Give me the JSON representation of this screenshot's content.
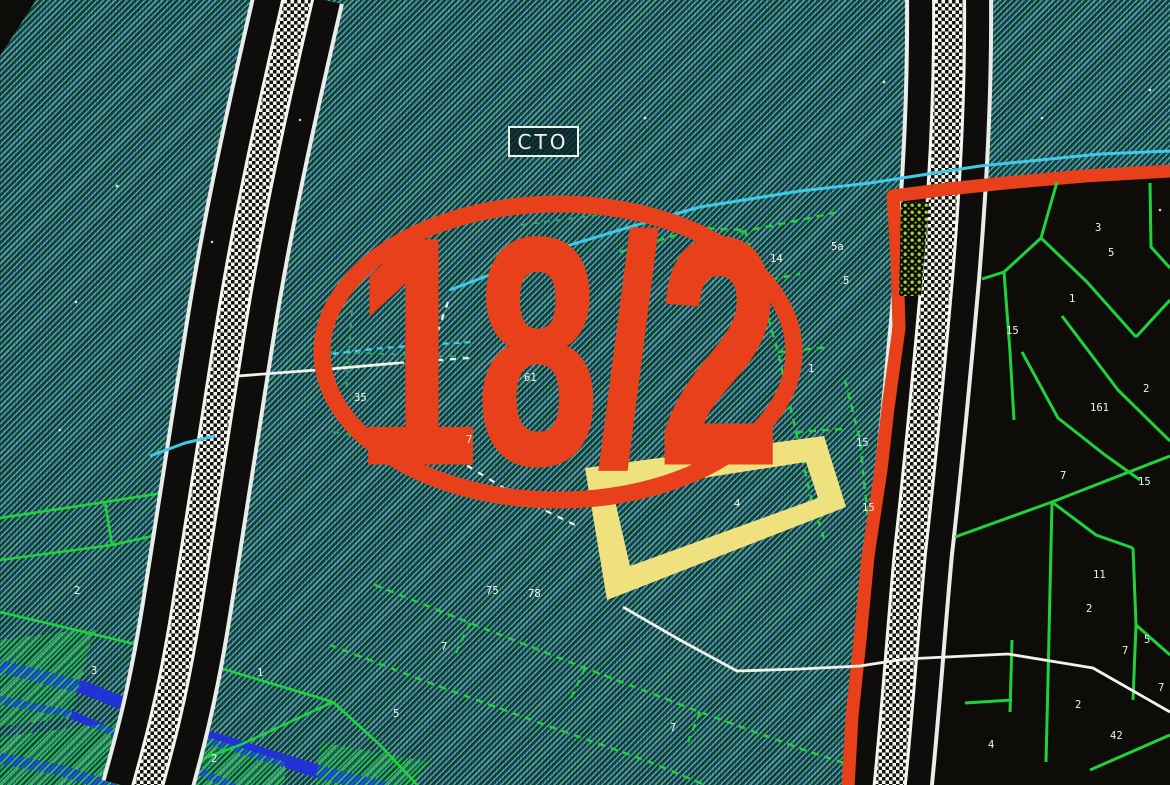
{
  "map": {
    "callout_text": "18/2",
    "station_label": "СТО",
    "colors": {
      "accent_red": "#e8401b",
      "parcel_green": "#1ed23c",
      "parcel_green_faint": "#2aa865",
      "water_blue": "#2133d6",
      "cyan": "#3fc9e8",
      "yellow": "#efe27e",
      "white": "#f2f2ec",
      "black": "#0d0c09",
      "teal_base": "#11544a",
      "strip_olive": "#a6cf3a"
    },
    "labels": [
      {
        "text": "14",
        "x": 770,
        "y": 262
      },
      {
        "text": "5а",
        "x": 831,
        "y": 250
      },
      {
        "text": "5",
        "x": 843,
        "y": 284
      },
      {
        "text": "1",
        "x": 808,
        "y": 372
      },
      {
        "text": "61",
        "x": 524,
        "y": 381
      },
      {
        "text": "35",
        "x": 354,
        "y": 401
      },
      {
        "text": "7",
        "x": 466,
        "y": 443
      },
      {
        "text": "15",
        "x": 856,
        "y": 446
      },
      {
        "text": "15",
        "x": 862,
        "y": 511
      },
      {
        "text": "4",
        "x": 734,
        "y": 507
      },
      {
        "text": "75",
        "x": 486,
        "y": 594
      },
      {
        "text": "78",
        "x": 528,
        "y": 597
      },
      {
        "text": "7",
        "x": 441,
        "y": 650
      },
      {
        "text": "5",
        "x": 393,
        "y": 717
      },
      {
        "text": "7",
        "x": 670,
        "y": 731
      },
      {
        "text": "1",
        "x": 257,
        "y": 676
      },
      {
        "text": "2",
        "x": 211,
        "y": 762
      },
      {
        "text": "3",
        "x": 91,
        "y": 674
      },
      {
        "text": "2",
        "x": 74,
        "y": 594
      },
      {
        "text": "3",
        "x": 1095,
        "y": 231
      },
      {
        "text": "5",
        "x": 1108,
        "y": 256
      },
      {
        "text": "1",
        "x": 1069,
        "y": 302
      },
      {
        "text": "15",
        "x": 1006,
        "y": 334
      },
      {
        "text": "161",
        "x": 1090,
        "y": 411
      },
      {
        "text": "2",
        "x": 1143,
        "y": 392
      },
      {
        "text": "15",
        "x": 1138,
        "y": 485
      },
      {
        "text": "7",
        "x": 1060,
        "y": 479
      },
      {
        "text": "11",
        "x": 1093,
        "y": 578
      },
      {
        "text": "2",
        "x": 1086,
        "y": 612
      },
      {
        "text": "7",
        "x": 1122,
        "y": 654
      },
      {
        "text": "42",
        "x": 1110,
        "y": 739
      },
      {
        "text": "2",
        "x": 1075,
        "y": 708
      },
      {
        "text": "5",
        "x": 1144,
        "y": 643,
        "color": "#e9e27b"
      },
      {
        "text": "7",
        "x": 1158,
        "y": 691,
        "color": "#e9e27b"
      },
      {
        "text": "4",
        "x": 988,
        "y": 748,
        "color": "#e9e27b"
      }
    ]
  }
}
